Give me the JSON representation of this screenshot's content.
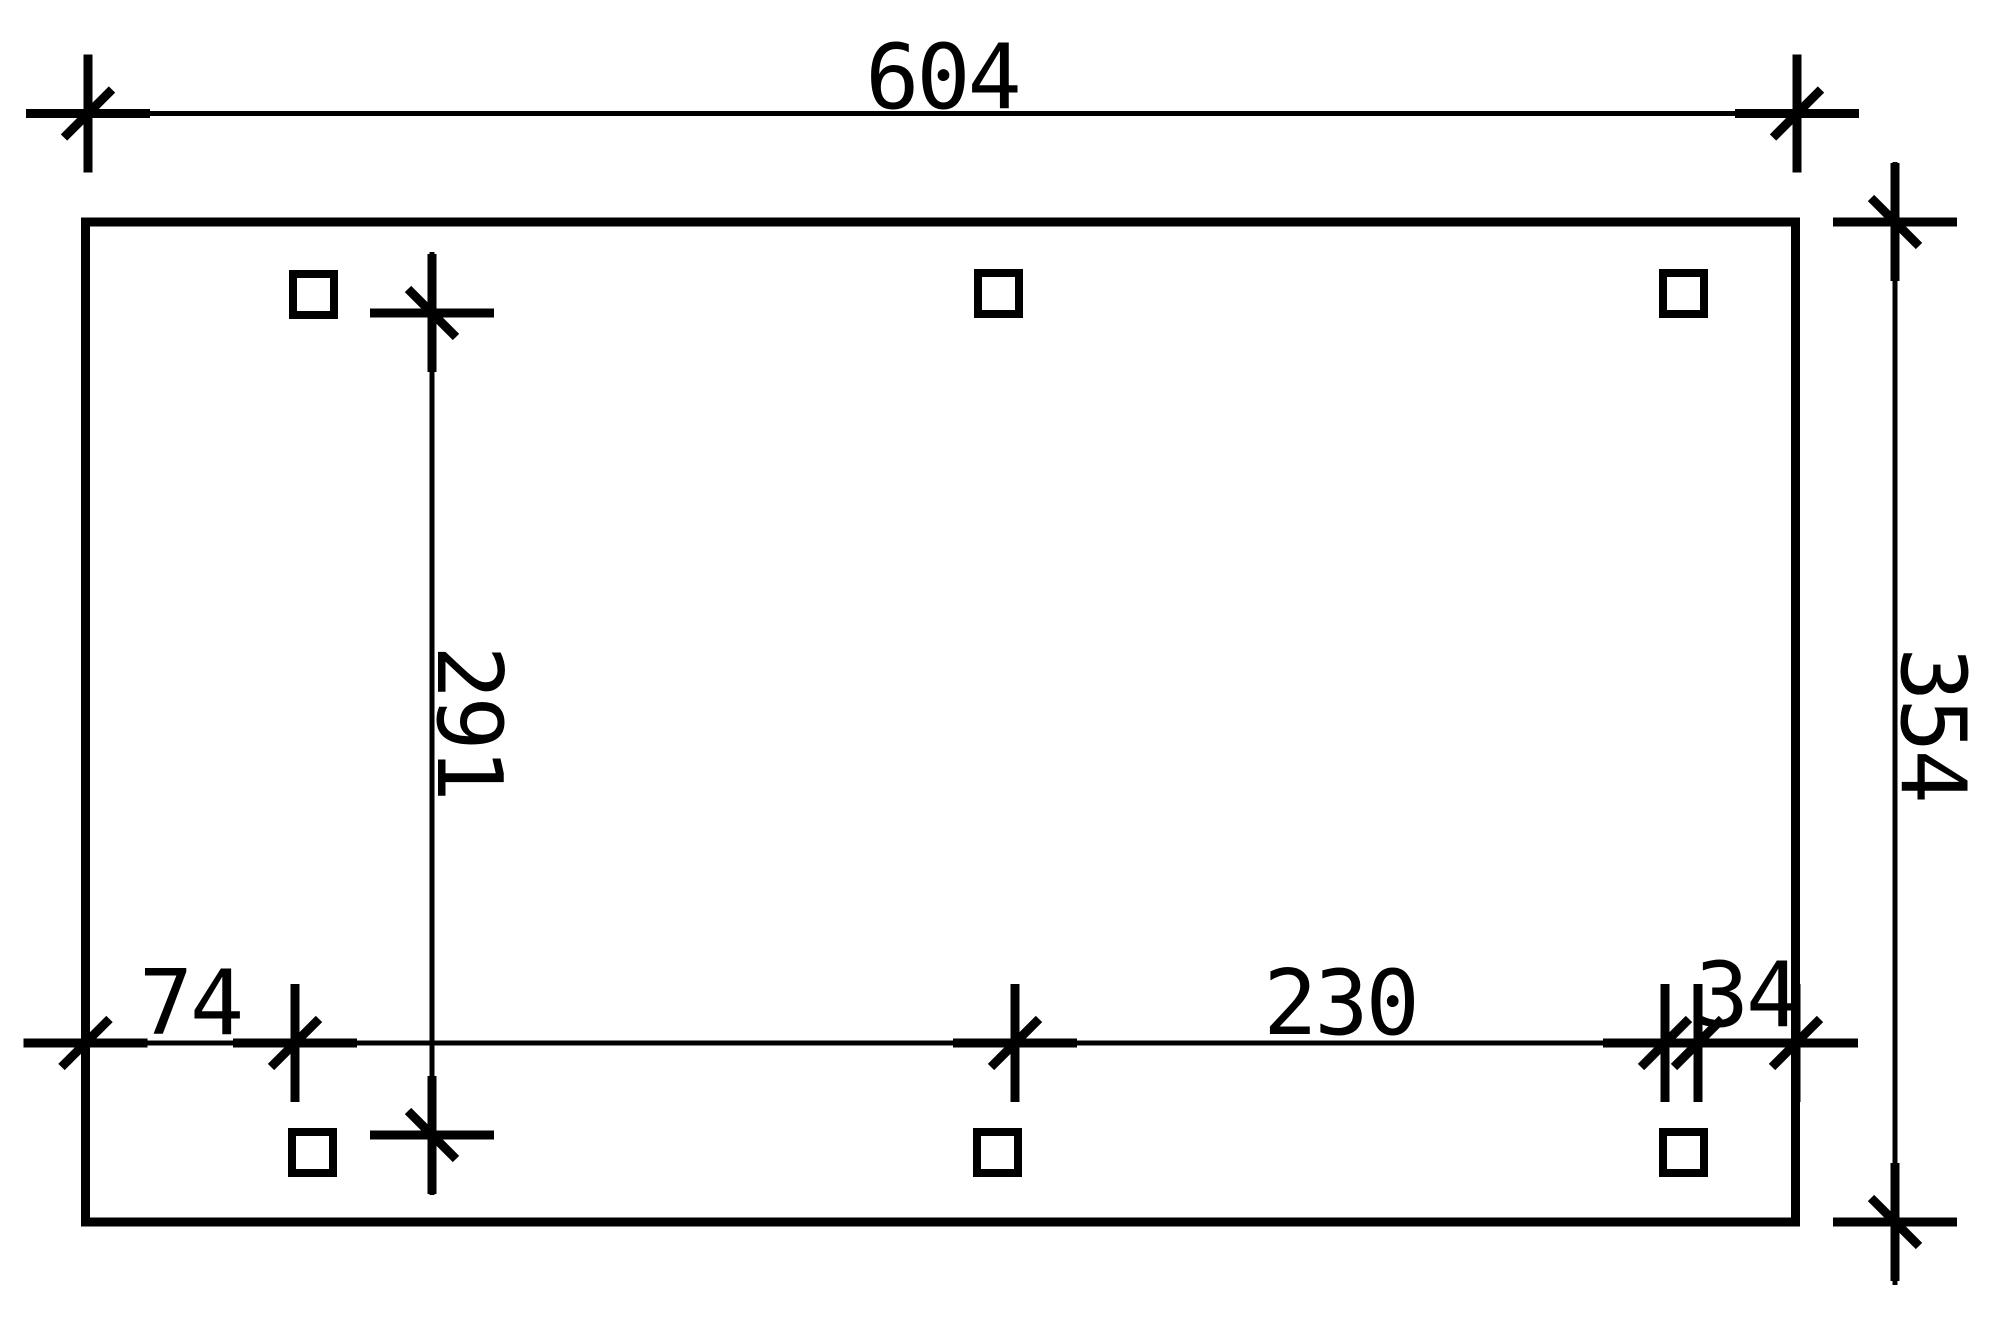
{
  "drawing": {
    "type": "carport-ground-plan",
    "paper_color": "#ffffff",
    "ink_color": "#000000",
    "dim_labels": {
      "total_width": "604",
      "total_depth": "354",
      "inner_post_clear_span_vertical": "291",
      "left_edge_to_post": "74",
      "post_clear_span_horizontal": "230",
      "post_to_right_edge": "34"
    },
    "posts": [
      {
        "x": 293,
        "y": 274
      },
      {
        "x": 978,
        "y": 273
      },
      {
        "x": 1663,
        "y": 273
      },
      {
        "x": 292,
        "y": 1132
      },
      {
        "x": 977,
        "y": 1132
      },
      {
        "x": 1663,
        "y": 1132
      }
    ],
    "post_size": 41
  }
}
